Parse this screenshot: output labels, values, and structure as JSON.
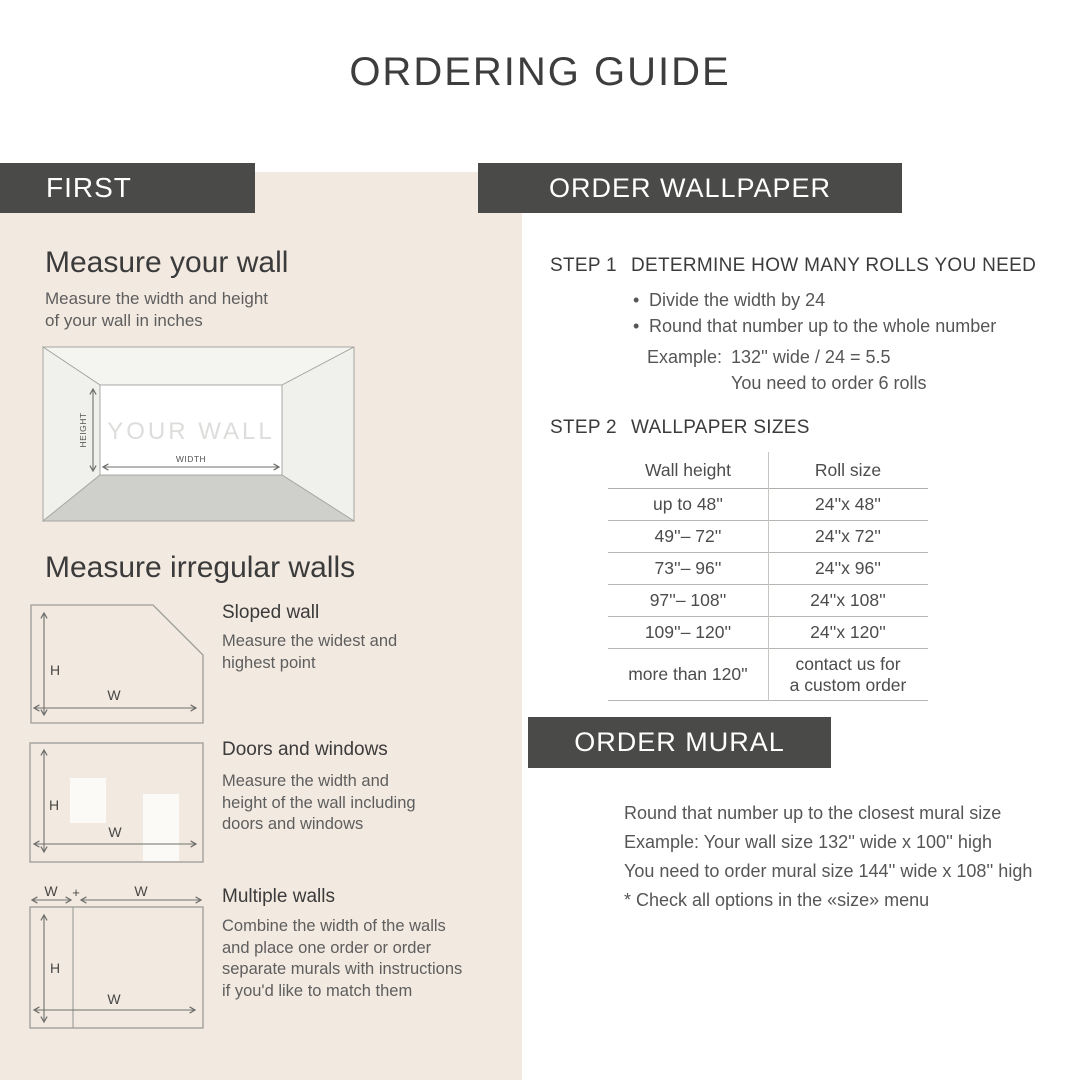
{
  "title": "ORDERING GUIDE",
  "first": {
    "header": "FIRST",
    "measure_wall_heading": "Measure your wall",
    "measure_wall_body": "Measure the width and height\nof your wall in inches",
    "wall_diagram": {
      "your_wall": "YOUR WALL",
      "height": "HEIGHT",
      "width": "WIDTH"
    },
    "irregular_heading": "Measure irregular walls",
    "labels": {
      "h": "H",
      "w": "W",
      "plus": "+"
    },
    "sloped": {
      "title": "Sloped wall",
      "body": "Measure the widest and\nhighest point"
    },
    "doors": {
      "title": "Doors and windows",
      "body": "Measure the width and\nheight of the wall including\ndoors and windows"
    },
    "multiple": {
      "title": "Multiple walls",
      "body": "Combine the width of the walls\nand place one order or order\nseparate murals with instructions\nif you'd like to match them"
    }
  },
  "wallpaper": {
    "header": "ORDER WALLPAPER",
    "bullet_glyph": "•",
    "step1_label": "STEP 1",
    "step1_title": "DETERMINE HOW MANY ROLLS YOU NEED",
    "bullets": [
      "Divide the width by 24",
      "Round that number up to the whole number"
    ],
    "example_label": "Example:",
    "example_line1": "132'' wide / 24 = 5.5",
    "example_line2": "You need to order 6 rolls",
    "step2_label": "STEP 2",
    "step2_title": "WALLPAPER SIZES",
    "table": {
      "columns": [
        "Wall height",
        "Roll size"
      ],
      "rows": [
        [
          "up to 48''",
          "24''x 48''"
        ],
        [
          "49''– 72''",
          "24''x 72''"
        ],
        [
          "73''– 96''",
          "24''x 96''"
        ],
        [
          "97''– 108''",
          "24''x 108''"
        ],
        [
          "109''– 120''",
          "24''x 120''"
        ],
        [
          "more than 120''",
          "contact us for\na custom order"
        ]
      ]
    }
  },
  "mural": {
    "header": "ORDER MURAL",
    "lines": [
      "Round that number up to the closest mural size",
      "Example: Your wall size 132'' wide x 100'' high",
      "You need to order mural size 144'' wide x 108'' high",
      "* Check all options in the «size» menu"
    ]
  },
  "colors": {
    "panel_beige": "#f2e9e0",
    "bar_dark": "#4a4a48",
    "heading_dark": "#3d3d3d",
    "body_gray": "#5e5e5e"
  }
}
